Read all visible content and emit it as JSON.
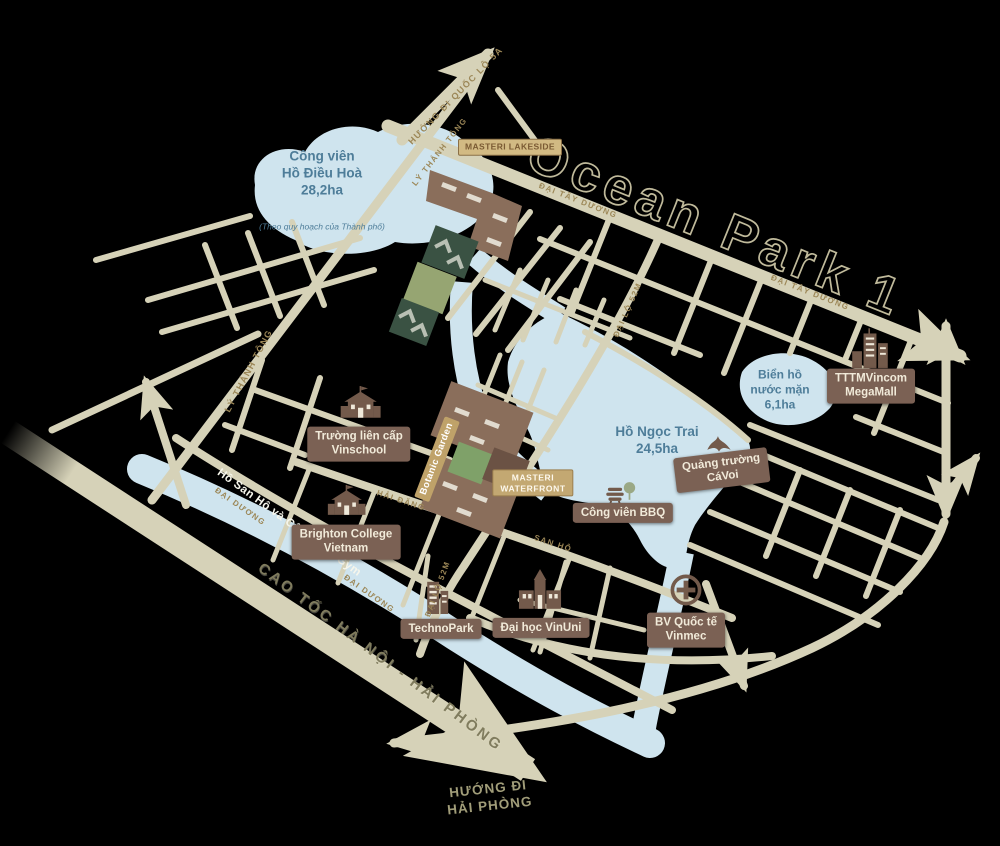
{
  "map": {
    "title": "Ocean Park 1"
  },
  "lakes": {
    "dieu_hoa": {
      "name": "Công viên\nHồ Điều Hoà\n28,2ha",
      "note": "(Theo quy hoạch của Thành phố)"
    },
    "ngoc_trai": {
      "name": "Hồ Ngọc Trai\n24,5ha"
    },
    "bien_ho": {
      "name": "Biển hồ\nnước mặn\n6,1ha"
    },
    "san_ho_gym": {
      "name": "Hồ San Hô và Công viên Gym"
    }
  },
  "pois": {
    "masteri_lakeside": {
      "label": "MASTERI LAKESIDE"
    },
    "masteri_waterfront": {
      "label": "MASTERI\nWATERFRONT"
    },
    "botanic_garden": {
      "label": "Botanic Garden"
    },
    "vinschool": {
      "label": "Trường liên cấp\nVinschool"
    },
    "brighton_college": {
      "label": "Brighton College\nVietnam"
    },
    "technopark": {
      "label": "TechnoPark"
    },
    "vinuni": {
      "label": "Đại học VinUni"
    },
    "vinmec": {
      "label": "BV Quốc tế\nVinmec"
    },
    "bbq_park": {
      "label": "Công viên BBQ"
    },
    "whale_square": {
      "label": "Quảng trường\nCáVoi"
    },
    "vincom_megamall": {
      "label": "TTTMVincom\nMegaMall"
    }
  },
  "road_labels": {
    "ql5a": "HƯỚNG ĐI QUỐC LỘ 5A",
    "ly_thanh_tong": "LÝ THÁNH TÔNG",
    "dai_tay_duong": "ĐẠI TÂY DƯƠNG",
    "dai_duong": "ĐẠI DƯƠNG",
    "hai_dang": "HẢI ĐĂNG",
    "san_ho": "SAN HÔ",
    "dai_lo_52m": "ĐẠI LỘ 52M",
    "cao_toc": "CAO TỐC HÀ NỘI - HẢI PHÒNG",
    "huong_di_hai_phong": "HƯỚNG ĐI\nHẢI PHÒNG"
  },
  "colors": {
    "road": "#d6d2b8",
    "water": "#cfe4ee",
    "water_text": "#4e7d99",
    "building": "#8a6e5b",
    "label_brown": "#7b6154",
    "label_tan": "#c3a872",
    "road_text": "#9c8757",
    "title_outline": "#cbc5a4",
    "dark_green": "#3a5243",
    "olive_green": "#96a572"
  }
}
